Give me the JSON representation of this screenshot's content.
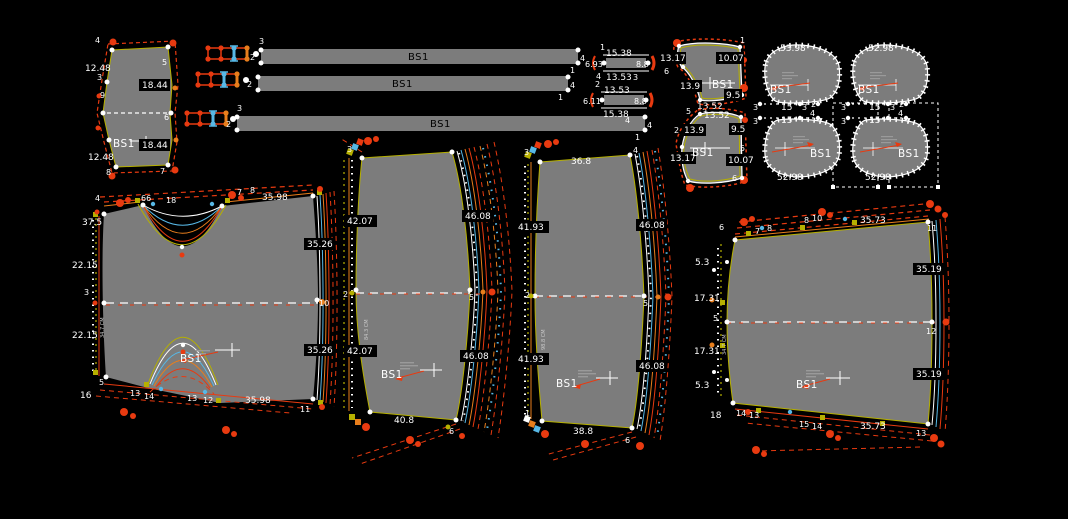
{
  "colors": {
    "background": "#000000",
    "piece_fill": "#7c7c7c",
    "outline_red": "#e83a10",
    "outline_orange": "#e87e1c",
    "outline_yellow": "#b6b000",
    "outline_cyan": "#57b8e6",
    "outline_white": "#ffffff"
  },
  "bars": {
    "bar1": {
      "label": "BS1",
      "n_top": "3",
      "n_left": "2",
      "n_right": "4",
      "n_bottom": "1"
    },
    "bar2": {
      "label": "BS1",
      "n_left": "2",
      "n_right": "4",
      "n_bottom": "1"
    },
    "bar3": {
      "label": "BS1",
      "n_top": "3",
      "n_left": "2",
      "n_right": "4",
      "n_bottom": "1"
    }
  },
  "small_piece": {
    "label": "BS1",
    "labels": [
      "4",
      "12.48",
      "3",
      "18.44",
      "9",
      "5",
      "6",
      "18.44",
      "12.48",
      "8",
      "7"
    ]
  },
  "strip_a": {
    "labels": [
      "1",
      "15.38",
      "6.93",
      "8.8",
      "13.53",
      "3",
      "4",
      "2"
    ]
  },
  "strip_b": {
    "labels": [
      "13.53",
      "6.11",
      "8.8",
      "15.38",
      "4"
    ]
  },
  "collar_top": {
    "label": "BS1",
    "labels": [
      "13.17",
      "10.07",
      "6",
      "13.9",
      "9.5",
      "13.52",
      "5",
      "3",
      "1"
    ]
  },
  "collar_bottom": {
    "label": "BS1",
    "labels": [
      "13.52",
      "2",
      "13.9",
      "9.5",
      "5",
      "13.17",
      "10.07",
      "6"
    ]
  },
  "oval_left": {
    "top_dim": "53.98",
    "bottom_dim": "52.98",
    "label_top": "BS1",
    "label_bottom": "BS1",
    "mid": [
      "3",
      "15",
      "3",
      "2",
      "4",
      "3",
      "15",
      "7"
    ]
  },
  "oval_right": {
    "top_dim": "52.98",
    "bottom_dim": "52.98",
    "label_top": "BS1",
    "label_bottom": "BS1",
    "mid": [
      "3",
      "15",
      "3",
      "2",
      "4",
      "3",
      "15",
      "7"
    ]
  },
  "piece1": {
    "label": "BS1",
    "side_text": "34.7 CM",
    "labels": [
      "4",
      "66",
      "18",
      "7",
      "8",
      "35.98",
      "37.5",
      "22.15",
      "3",
      "22.15",
      "16",
      "5",
      "13",
      "14",
      "13",
      "12",
      "35.98",
      "11",
      "35.26",
      "10",
      "35.26"
    ]
  },
  "piece2": {
    "label": "BS1",
    "side_text": "84.3 CM",
    "labels": [
      "3",
      "42.07",
      "46.08",
      "2",
      "5",
      "42.07",
      "46.08",
      "40.8",
      "6"
    ]
  },
  "piece3": {
    "label": "BS1",
    "side_text": "98.8 CM",
    "labels": [
      "3",
      "36.8",
      "4",
      "41.93",
      "46.08",
      "2",
      "5",
      "41.93",
      "46.08",
      "1",
      "38.8",
      "6"
    ]
  },
  "piece4": {
    "label": "BS1",
    "side_text": "34.7 CM",
    "labels": [
      "6",
      "7",
      "8",
      "8",
      "10",
      "35.73",
      "11",
      "5.3",
      "17.31",
      "5",
      "17.31",
      "5.3",
      "18",
      "35.19",
      "12",
      "35.19",
      "14",
      "13",
      "15",
      "14",
      "35.73",
      "13"
    ]
  }
}
